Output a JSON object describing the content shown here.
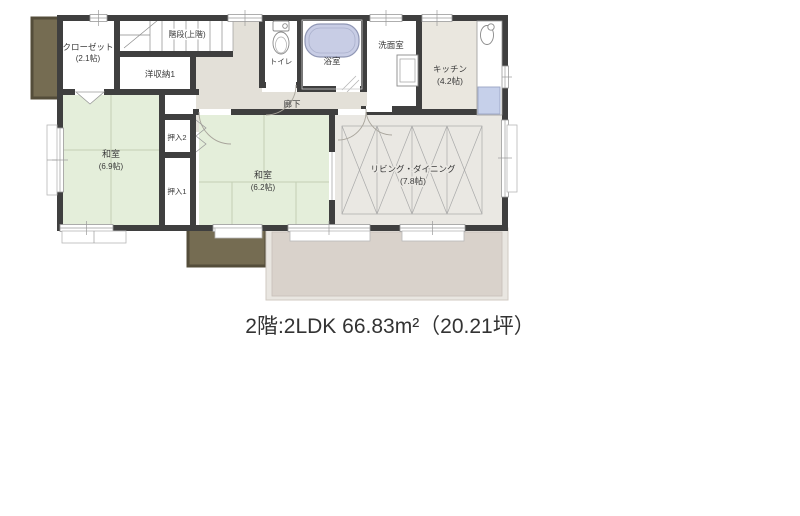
{
  "title": "2階:2LDK 66.83m²（20.21坪）",
  "rooms": {
    "closet": {
      "name": "クローゼット",
      "size": "(2.1帖)"
    },
    "stairs": {
      "name": "階段(上階)"
    },
    "storage": {
      "name": "洋収納1"
    },
    "toilet": {
      "name": "トイレ"
    },
    "bath": {
      "name": "浴室"
    },
    "washroom": {
      "name": "洗面室"
    },
    "kitchen": {
      "name": "キッチン",
      "size": "(4.2帖)"
    },
    "hallway": {
      "name": "廊下"
    },
    "japanese_room_1": {
      "name": "和室",
      "size": "(6.9帖)"
    },
    "japanese_room_2": {
      "name": "和室",
      "size": "(6.2帖)"
    },
    "closet_1": {
      "name": "押入1"
    },
    "closet_2": {
      "name": "押入2"
    },
    "living_dining": {
      "name": "リビング・ダイニング",
      "size": "(7.8帖)"
    }
  },
  "colors": {
    "wall": "#3f3f3f",
    "tatami_green": "#e4eeda",
    "hallway_gray": "#e3e0d8",
    "living_gray": "#eae8e3",
    "kitchen_beige": "#eae7df",
    "balcony_brown": "#756c52",
    "terrace_beige": "#d9d2cb",
    "bathtub_blue": "#c8cde5",
    "appliance_blue": "#c6d0ea"
  }
}
